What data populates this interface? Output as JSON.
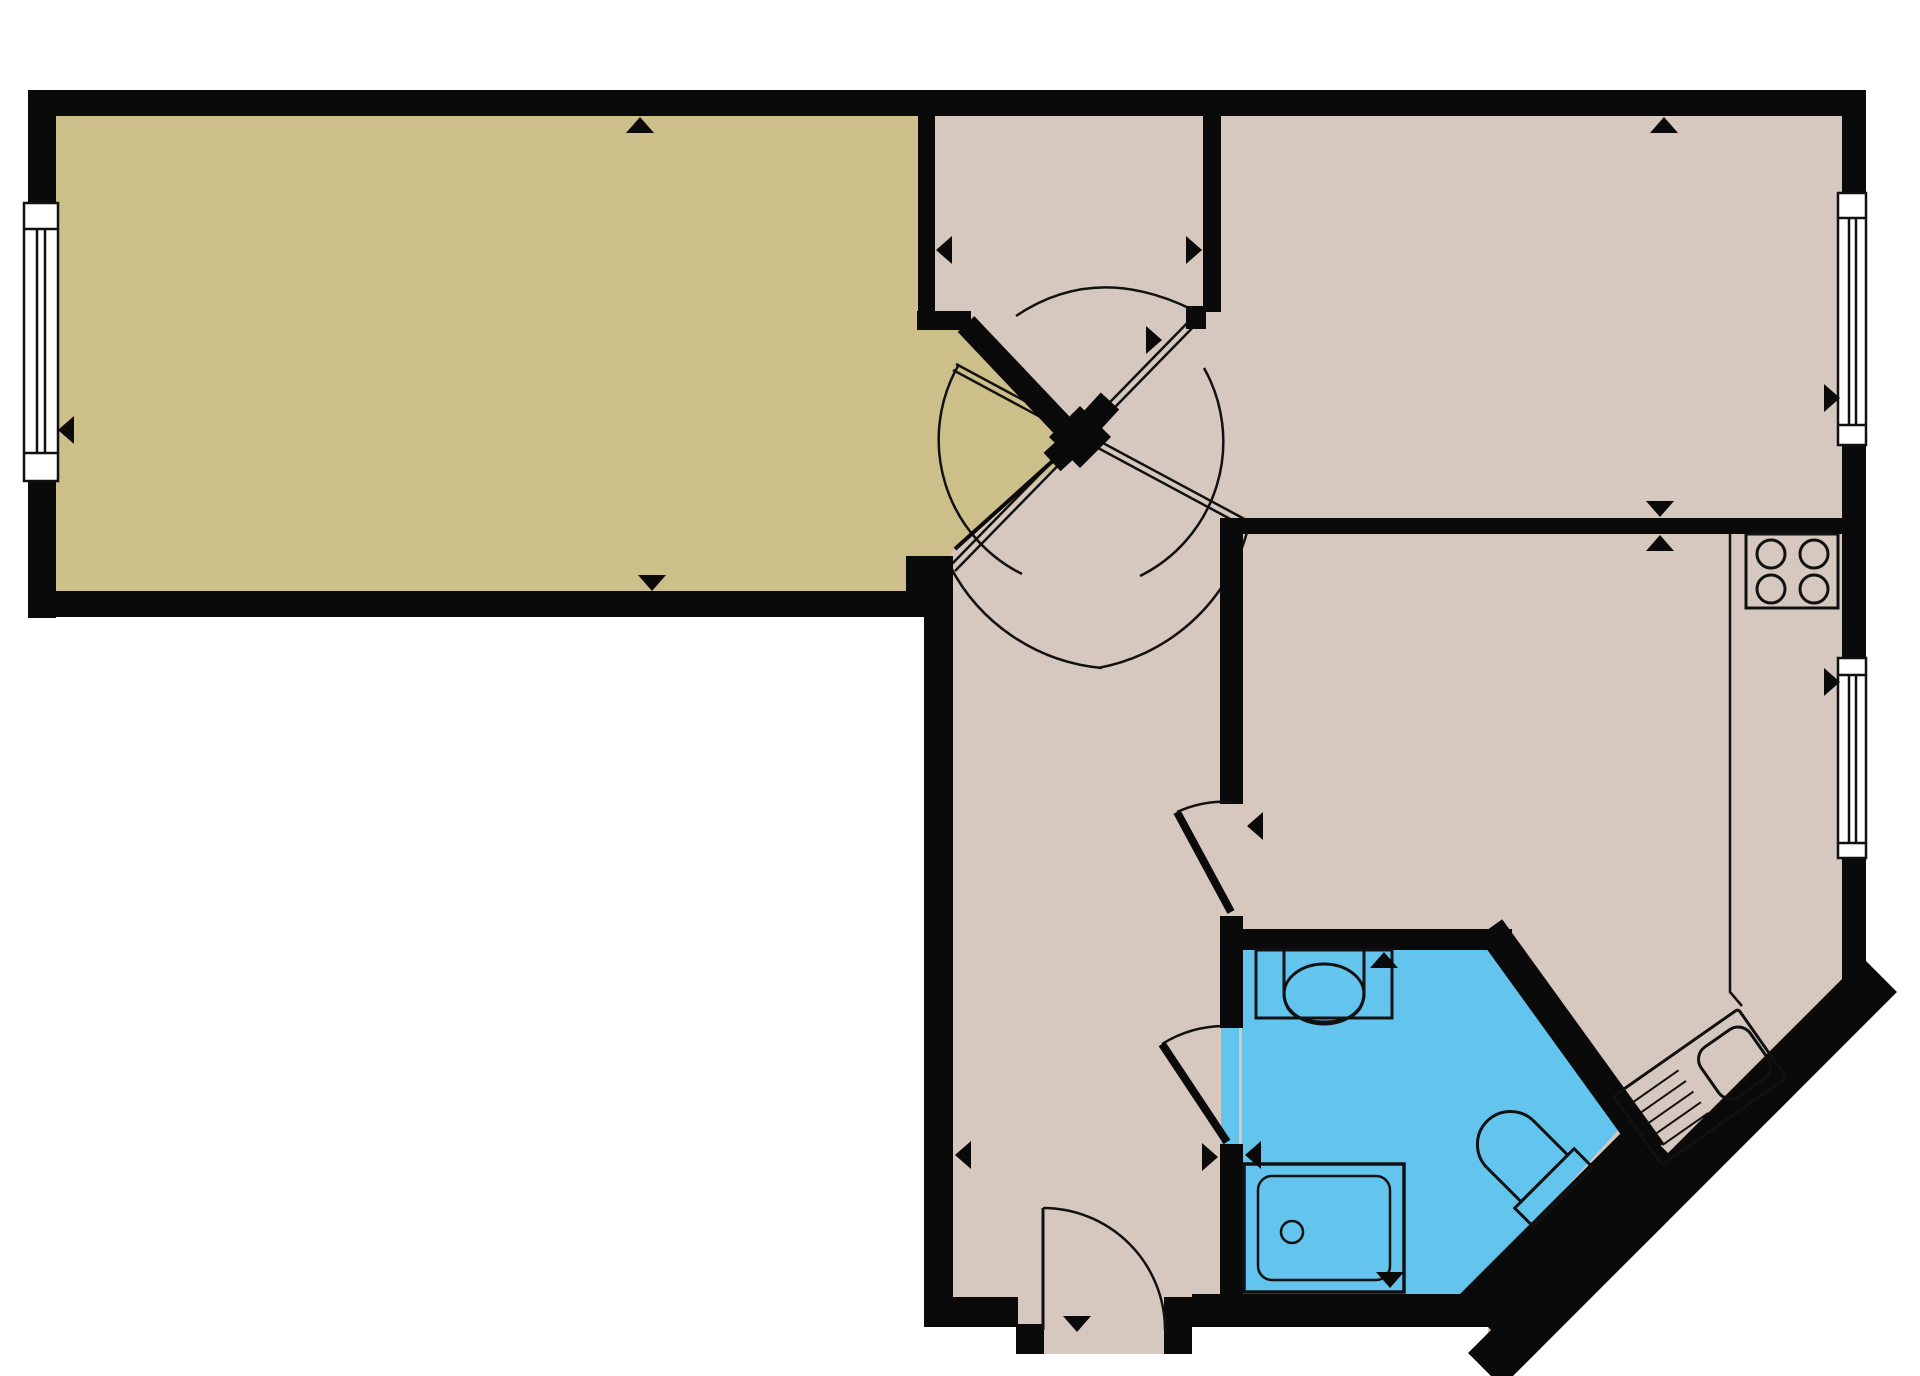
{
  "meta": {
    "kind": "apartment-floor-plan",
    "width_px": 1920,
    "height_px": 1376
  },
  "colors": {
    "wall": "#0a0a0a",
    "outline": "#111111",
    "living": "#cdbf8a",
    "rooms": "#d6c8be",
    "bath": "#63c5ee",
    "window": "#ffffff",
    "outside": "#ffffff"
  },
  "rooms": [
    {
      "id": "living-room",
      "color": "#cdbf8a"
    },
    {
      "id": "hall-vestibule",
      "color": "#d6c8be"
    },
    {
      "id": "bedroom",
      "color": "#d6c8be"
    },
    {
      "id": "corridor",
      "color": "#d6c8be"
    },
    {
      "id": "kitchen",
      "color": "#d6c8be"
    },
    {
      "id": "bathroom",
      "color": "#63c5ee"
    }
  ],
  "fixtures": [
    {
      "id": "stove",
      "burners": 4
    },
    {
      "id": "kitchen-sink-with-drainboard"
    },
    {
      "id": "washbasin"
    },
    {
      "id": "shower-tray"
    },
    {
      "id": "toilet"
    },
    {
      "id": "kitchen-counter"
    }
  ],
  "openings": {
    "windows": [
      {
        "id": "living-room-window",
        "wall": "left"
      },
      {
        "id": "bedroom-window",
        "wall": "right"
      },
      {
        "id": "kitchen-window",
        "wall": "right"
      }
    ],
    "doors": [
      {
        "id": "entrance-door",
        "wall": "bottom"
      },
      {
        "id": "living-room-door",
        "at": "central-junction"
      },
      {
        "id": "bedroom-door",
        "at": "central-junction"
      },
      {
        "id": "kitchen-door",
        "from": "corridor"
      },
      {
        "id": "bathroom-door",
        "from": "corridor"
      }
    ]
  }
}
